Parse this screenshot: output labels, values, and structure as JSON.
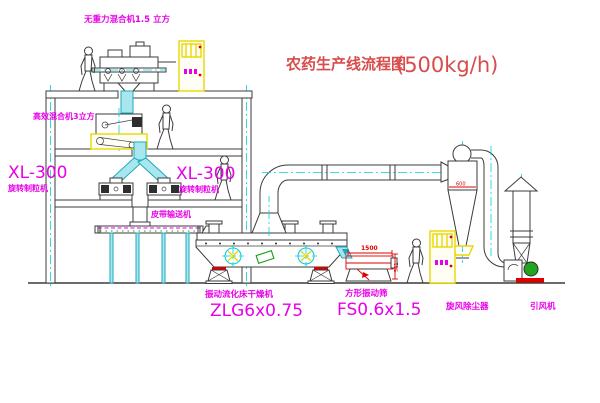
{
  "title": {
    "name": "农药生产线流程图",
    "capacity": "(500kg/h)"
  },
  "equipment_labels": {
    "gravity_mixer": "无重力混合机1.5 立方",
    "high_efficiency_mixer": "高效混合机3立方",
    "granulator_left": {
      "model": "XL-300",
      "name": "旋转制粒机"
    },
    "granulator_right": {
      "model": "XL-300",
      "name": "旋转制粒机"
    },
    "belt_conveyor": "皮带输送机",
    "dryer": {
      "name": "振动流化床干燥机",
      "model": "ZLG6x0.75"
    },
    "sieve": {
      "name": "方形振动筛",
      "model": "FS0.6x1.5"
    },
    "cyclone": "旋风除尘器",
    "fan": "引风机"
  },
  "dimension_texts": {
    "sieve_length": "1500",
    "sieve_height": "541",
    "cyclone_width": "600"
  },
  "colors": {
    "label_magenta": "#e800e8",
    "title_red": "#d84c4c",
    "dimension_red": "#dd0000",
    "pipe_cyan": "#1fa8bc",
    "machine_line": "#3b3b3b",
    "cabinet_yellow": "#e8d800",
    "motor_green": "#1fa51f",
    "background": "#ffffff"
  }
}
